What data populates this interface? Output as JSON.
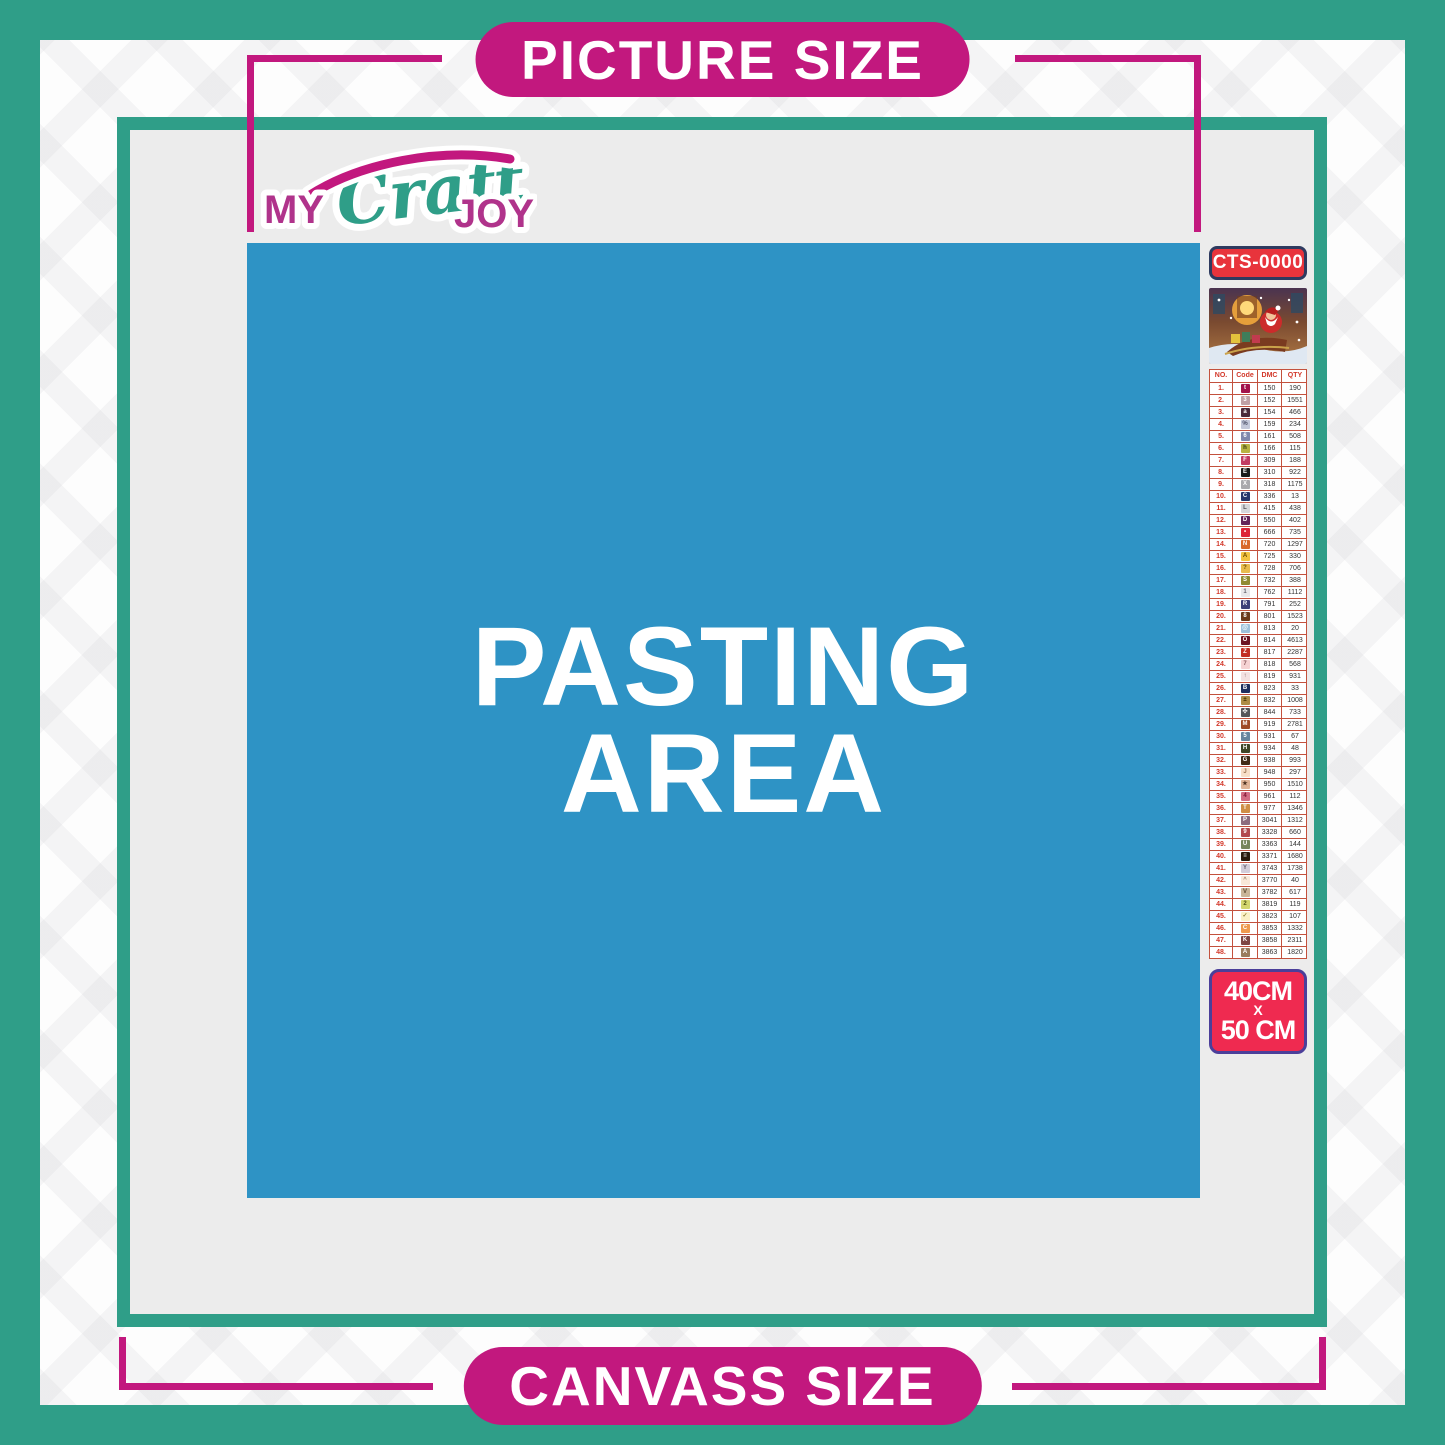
{
  "banner": {
    "top_label": "PICTURE SIZE",
    "bottom_label": "CANVASS SIZE"
  },
  "logo": {
    "my": "MY",
    "craft": "Craft",
    "joy": "JOY"
  },
  "pasting_area": {
    "line1": "PASTING",
    "line2": "AREA"
  },
  "legend": {
    "sku": "CTS-0000",
    "preview_icon": "santa-sleigh-christmas-preview",
    "size": {
      "width": "40CM",
      "separator": "X",
      "height": "50 CM"
    },
    "table": {
      "headers": [
        "NO.",
        "Code",
        "DMC",
        "QTY"
      ],
      "rows": [
        {
          "no": "1.",
          "sym": "t",
          "dmc": "150",
          "qty": "190",
          "bg": "#a3134b",
          "fg": "#ffffff"
        },
        {
          "no": "2.",
          "sym": "3",
          "dmc": "152",
          "qty": "1551",
          "bg": "#bfa0a5",
          "fg": "#ffffff"
        },
        {
          "no": "3.",
          "sym": "a",
          "dmc": "154",
          "qty": "466",
          "bg": "#4a2b3a",
          "fg": "#ffffff"
        },
        {
          "no": "4.",
          "sym": "%",
          "dmc": "159",
          "qty": "234",
          "bg": "#c3c8d9",
          "fg": "#4a4f66"
        },
        {
          "no": "5.",
          "sym": "6",
          "dmc": "161",
          "qty": "508",
          "bg": "#8089ad",
          "fg": "#ffffff"
        },
        {
          "no": "6.",
          "sym": "h",
          "dmc": "166",
          "qty": "115",
          "bg": "#b7b342",
          "fg": "#33350e"
        },
        {
          "no": "7.",
          "sym": "F",
          "dmc": "309",
          "qty": "188",
          "bg": "#c13b63",
          "fg": "#ffffff"
        },
        {
          "no": "8.",
          "sym": "E",
          "dmc": "310",
          "qty": "922",
          "bg": "#1a1a1a",
          "fg": "#ffffff"
        },
        {
          "no": "9.",
          "sym": "X",
          "dmc": "318",
          "qty": "1175",
          "bg": "#a9a9ad",
          "fg": "#ffffff"
        },
        {
          "no": "10.",
          "sym": "C",
          "dmc": "336",
          "qty": "13",
          "bg": "#28386b",
          "fg": "#ffffff"
        },
        {
          "no": "11.",
          "sym": "L",
          "dmc": "415",
          "qty": "438",
          "bg": "#d6d6da",
          "fg": "#55555c"
        },
        {
          "no": "12.",
          "sym": "D",
          "dmc": "550",
          "qty": "402",
          "bg": "#642157",
          "fg": "#ffffff"
        },
        {
          "no": "13.",
          "sym": "•",
          "dmc": "666",
          "qty": "735",
          "bg": "#dd2338",
          "fg": "#ffffff"
        },
        {
          "no": "14.",
          "sym": "N",
          "dmc": "720",
          "qty": "1297",
          "bg": "#d96a2b",
          "fg": "#ffffff"
        },
        {
          "no": "15.",
          "sym": "A",
          "dmc": "725",
          "qty": "330",
          "bg": "#f2c23f",
          "fg": "#6b4b00"
        },
        {
          "no": "16.",
          "sym": "?",
          "dmc": "728",
          "qty": "706",
          "bg": "#e8bb4e",
          "fg": "#6b4b00"
        },
        {
          "no": "17.",
          "sym": "S",
          "dmc": "732",
          "qty": "388",
          "bg": "#8f8a33",
          "fg": "#ffffff"
        },
        {
          "no": "18.",
          "sym": "1",
          "dmc": "762",
          "qty": "1112",
          "bg": "#e8e8ea",
          "fg": "#666670"
        },
        {
          "no": "19.",
          "sym": "R",
          "dmc": "791",
          "qty": "252",
          "bg": "#3b3f77",
          "fg": "#ffffff"
        },
        {
          "no": "20.",
          "sym": "8",
          "dmc": "801",
          "qty": "1523",
          "bg": "#6b3a1c",
          "fg": "#ffffff"
        },
        {
          "no": "21.",
          "sym": "@",
          "dmc": "813",
          "qty": "20",
          "bg": "#9cc0da",
          "fg": "#ffffff"
        },
        {
          "no": "22.",
          "sym": "O",
          "dmc": "814",
          "qty": "4613",
          "bg": "#6e1423",
          "fg": "#ffffff"
        },
        {
          "no": "23.",
          "sym": "Z",
          "dmc": "817",
          "qty": "2287",
          "bg": "#c22f24",
          "fg": "#ffffff"
        },
        {
          "no": "24.",
          "sym": "7",
          "dmc": "818",
          "qty": "568",
          "bg": "#f6d3d4",
          "fg": "#8a5a5e"
        },
        {
          "no": "25.",
          "sym": "↑",
          "dmc": "819",
          "qty": "931",
          "bg": "#f3e2e2",
          "fg": "#8a6a6a"
        },
        {
          "no": "26.",
          "sym": "B",
          "dmc": "823",
          "qty": "33",
          "bg": "#1f2f5e",
          "fg": "#ffffff"
        },
        {
          "no": "27.",
          "sym": "±",
          "dmc": "832",
          "qty": "1008",
          "bg": "#ad8c46",
          "fg": "#3a2c00"
        },
        {
          "no": "28.",
          "sym": "✣",
          "dmc": "844",
          "qty": "733",
          "bg": "#55565a",
          "fg": "#ffffff"
        },
        {
          "no": "29.",
          "sym": "M",
          "dmc": "919",
          "qty": "2781",
          "bg": "#9e4a27",
          "fg": "#ffffff"
        },
        {
          "no": "30.",
          "sym": "5",
          "dmc": "931",
          "qty": "67",
          "bg": "#67859e",
          "fg": "#ffffff"
        },
        {
          "no": "31.",
          "sym": "H",
          "dmc": "934",
          "qty": "48",
          "bg": "#3e4526",
          "fg": "#ffffff"
        },
        {
          "no": "32.",
          "sym": "G",
          "dmc": "938",
          "qty": "993",
          "bg": "#402a16",
          "fg": "#ffffff"
        },
        {
          "no": "33.",
          "sym": "J",
          "dmc": "948",
          "qty": "297",
          "bg": "#f7dfc9",
          "fg": "#9a7250"
        },
        {
          "no": "34.",
          "sym": "★",
          "dmc": "950",
          "qty": "1510",
          "bg": "#dfb396",
          "fg": "#4a3120"
        },
        {
          "no": "35.",
          "sym": "4",
          "dmc": "961",
          "qty": "112",
          "bg": "#d16d84",
          "fg": "#7b1430"
        },
        {
          "no": "36.",
          "sym": "T",
          "dmc": "977",
          "qty": "1346",
          "bg": "#cf8e46",
          "fg": "#ffffff"
        },
        {
          "no": "37.",
          "sym": "P",
          "dmc": "3041",
          "qty": "1312",
          "bg": "#8d6b7e",
          "fg": "#ffffff"
        },
        {
          "no": "38.",
          "sym": "9",
          "dmc": "3328",
          "qty": "660",
          "bg": "#b14a4f",
          "fg": "#ffffff"
        },
        {
          "no": "39.",
          "sym": "U",
          "dmc": "3363",
          "qty": "144",
          "bg": "#77865c",
          "fg": "#ffffff"
        },
        {
          "no": "40.",
          "sym": "≡",
          "dmc": "3371",
          "qty": "1680",
          "bg": "#2a1a0d",
          "fg": "#ffffff"
        },
        {
          "no": "41.",
          "sym": "Y",
          "dmc": "3743",
          "qty": "1738",
          "bg": "#d3cdd9",
          "fg": "#66606e"
        },
        {
          "no": "42.",
          "sym": "^",
          "dmc": "3770",
          "qty": "40",
          "bg": "#f8e8d8",
          "fg": "#9a8068"
        },
        {
          "no": "43.",
          "sym": "V",
          "dmc": "3782",
          "qty": "617",
          "bg": "#c9b599",
          "fg": "#5d4c34"
        },
        {
          "no": "44.",
          "sym": "2",
          "dmc": "3819",
          "qty": "119",
          "bg": "#d3d66e",
          "fg": "#4f5412"
        },
        {
          "no": "45.",
          "sym": "✓",
          "dmc": "3823",
          "qty": "107",
          "bg": "#faf0c6",
          "fg": "#8a7c30"
        },
        {
          "no": "46.",
          "sym": "C",
          "dmc": "3853",
          "qty": "1332",
          "bg": "#ee9a4e",
          "fg": "#ffffff"
        },
        {
          "no": "47.",
          "sym": "K",
          "dmc": "3858",
          "qty": "2311",
          "bg": "#7e4644",
          "fg": "#ffffff"
        },
        {
          "no": "48.",
          "sym": "A",
          "dmc": "3863",
          "qty": "1820",
          "bg": "#997b5e",
          "fg": "#ffffff"
        }
      ]
    }
  },
  "colors": {
    "teal": "#2f9e88",
    "magenta": "#c2187e",
    "pasting_blue": "#2e93c5",
    "canvas_gray": "#ececec",
    "sku_badge_red": "#e8343c",
    "size_badge_red": "#ef2a50",
    "table_border_red": "#c3513d"
  }
}
